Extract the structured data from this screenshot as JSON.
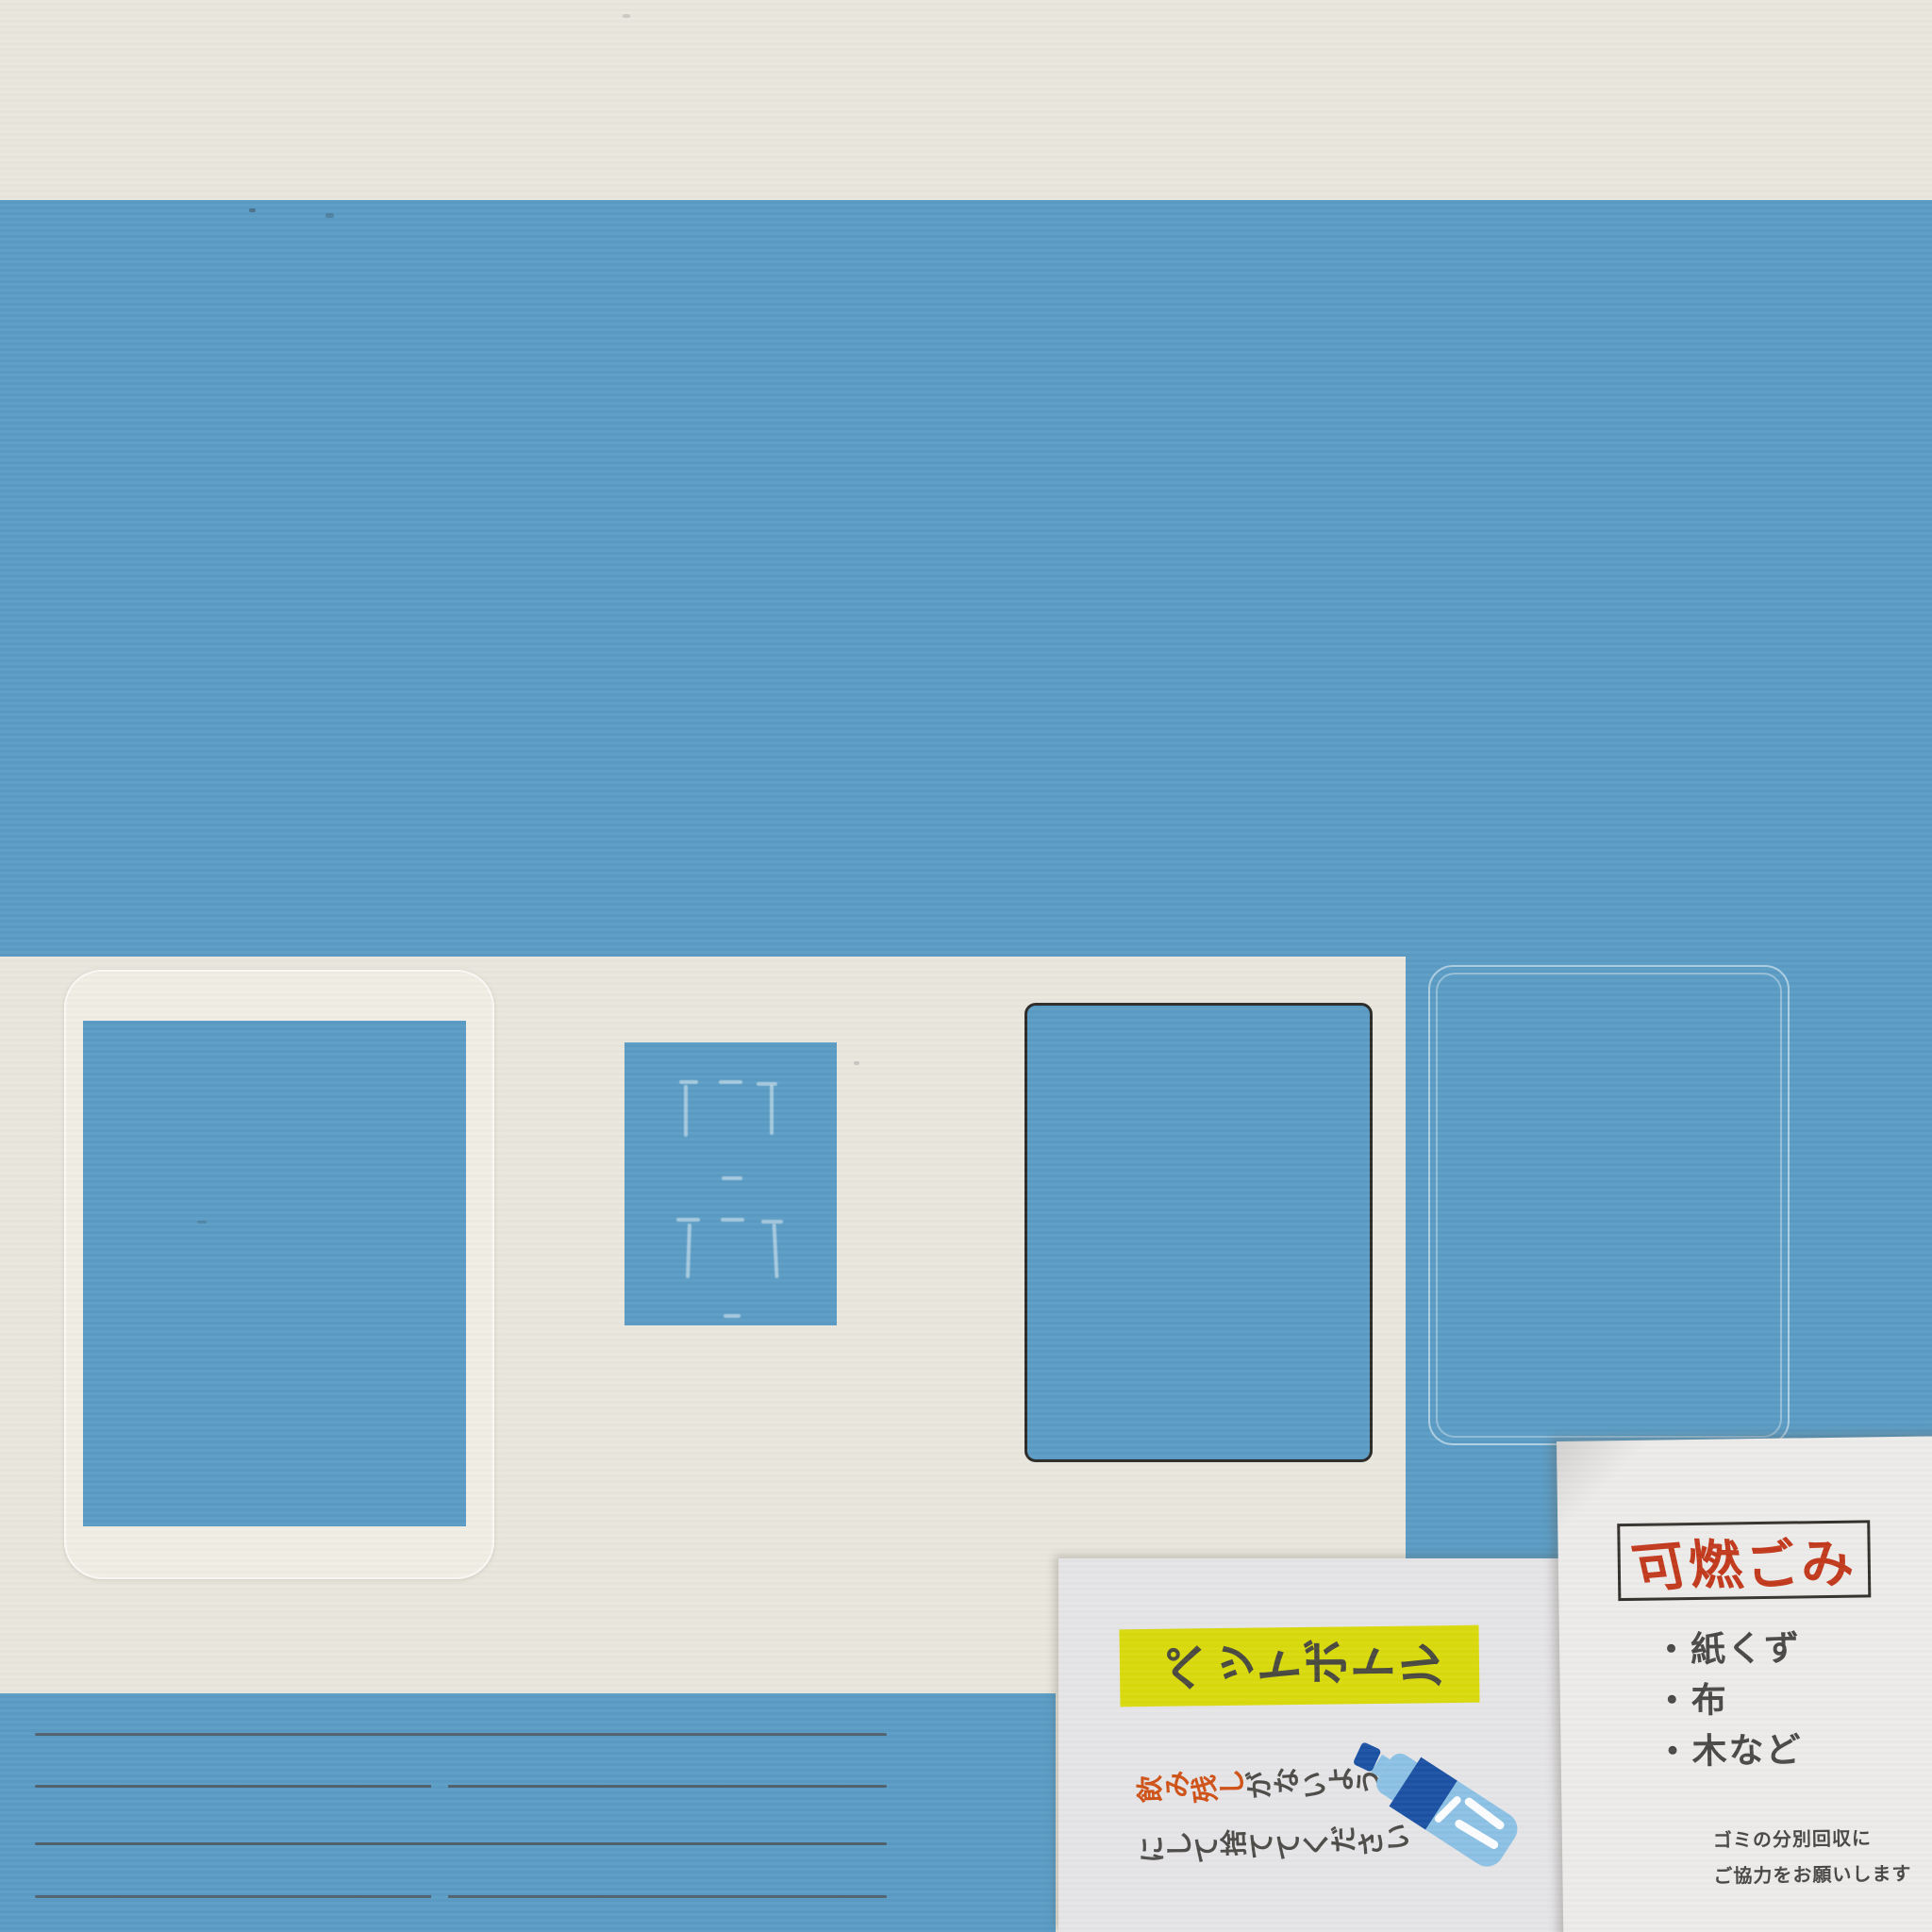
{
  "scene": {
    "description": "Wall of a refuse collection point: cream wall with blue painted band and rectangles, ruled notice panel, and two pasted signs",
    "colors": {
      "wall_cream": "#e9e6dd",
      "paint_blue": "#5b9cc4",
      "rule_line_gray": "#4f5358",
      "pet_poster_bg": "#e5e4e7",
      "burnable_poster_bg": "#ecebea",
      "highlight_yellow": "#d9da0c",
      "ink_dark_gray": "#4a4a42",
      "title_red": "#c23a1d",
      "note_orange": "#cf5318",
      "bottle_light_blue": "#8cc1e4",
      "bottle_dark_blue": "#1c52a4"
    }
  },
  "posters": {
    "pet_bottle": {
      "title": "ペットボトル",
      "note_highlight": "飲み残し",
      "note_rest": "がないよう",
      "note_line2": "にして捨ててください"
    },
    "burnable": {
      "title": "可燃ごみ",
      "items": [
        "・紙くず",
        "・布",
        "・木など"
      ],
      "footer_lines": [
        "ゴミの分別回収に",
        "ご協力をお願いします"
      ]
    }
  },
  "icons": {
    "pet_bottle": "pet-bottle-illustration"
  }
}
